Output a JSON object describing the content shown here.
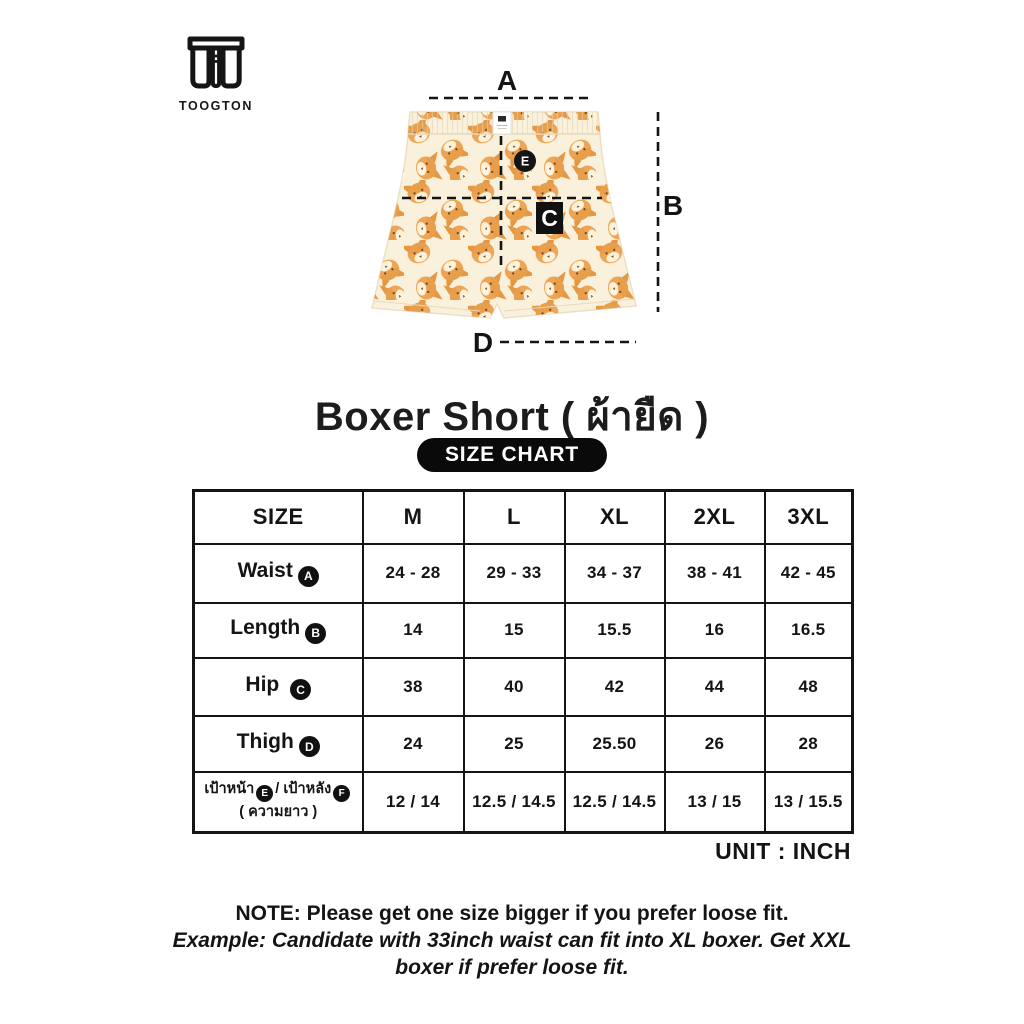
{
  "brand": {
    "name": "TOOGTON",
    "logo_icon": "boxer-shorts-icon"
  },
  "diagram": {
    "label_a": "A",
    "label_b": "B",
    "label_c": "C",
    "label_d": "D",
    "label_e": "E"
  },
  "title": "Boxer Short ( ผ้ายืด )",
  "size_chart_badge": "SIZE CHART",
  "table": {
    "headers": [
      "SIZE",
      "M",
      "L",
      "XL",
      "2XL",
      "3XL"
    ],
    "rows": [
      {
        "label": "Waist",
        "marker": "A",
        "values": [
          "24 - 28",
          "29 - 33",
          "34 - 37",
          "38 - 41",
          "42 - 45"
        ]
      },
      {
        "label": "Length",
        "marker": "B",
        "values": [
          "14",
          "15",
          "15.5",
          "16",
          "16.5"
        ]
      },
      {
        "label": "Hip",
        "marker": "C",
        "values": [
          "38",
          "40",
          "42",
          "44",
          "48"
        ]
      },
      {
        "label": "Thigh",
        "marker": "D",
        "values": [
          "24",
          "25",
          "25.50",
          "26",
          "28"
        ]
      },
      {
        "label_front": "เป้าหน้า",
        "marker_front": "E",
        "label_divider": "/",
        "label_back": "เป้าหลัง",
        "marker_back": "F",
        "label_sub": "( ความยาว )",
        "values": [
          "12 / 14",
          "12.5 / 14.5",
          "12.5 / 14.5",
          "13 / 15",
          "13 / 15.5"
        ]
      }
    ]
  },
  "unit_label": "UNIT : INCH",
  "note": {
    "line1": "NOTE: Please get one size bigger if you prefer loose fit.",
    "line2": "Example: Candidate with 33inch waist can fit into XL boxer. Get XXL",
    "line3": "boxer if prefer loose fit."
  },
  "colors": {
    "ink": "#141414",
    "fabric_cream": "#faf1dd",
    "cat_orange": "#eda24f",
    "cat_feature_brown": "#6b4119",
    "pill_bg": "#0a0a0a",
    "pill_text": "#ffffff"
  }
}
